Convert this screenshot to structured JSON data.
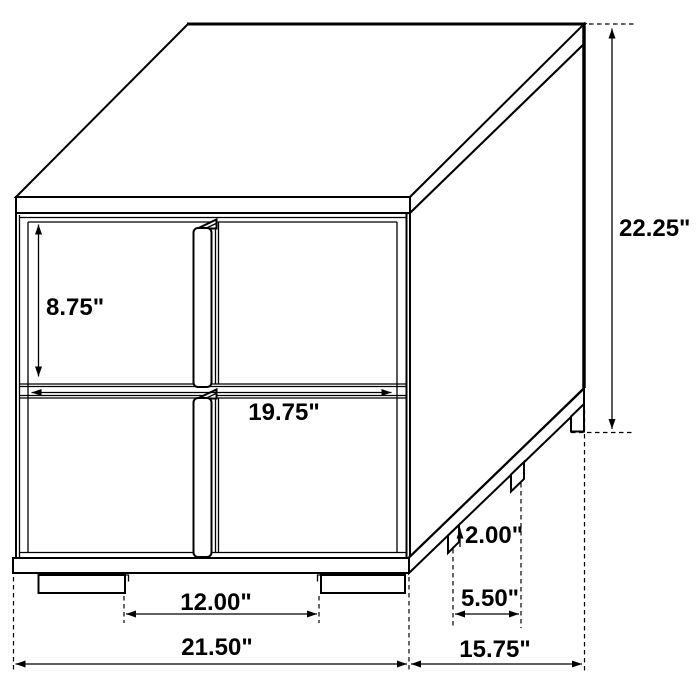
{
  "diagram": {
    "title": "Two-drawer nightstand dimension drawing",
    "view": "isometric line drawing",
    "units": "inches",
    "colors": {
      "line": "#000000",
      "background": "#ffffff"
    },
    "labels": {
      "drawer_height": "8.75\"",
      "overall_height": "22.25\"",
      "drawer_width": "19.75\"",
      "foot_height": "2.00\"",
      "side_foot_spacing": "5.50\"",
      "front_foot_gap": "12.00\"",
      "overall_width": "21.50\"",
      "overall_depth": "15.75\""
    }
  }
}
